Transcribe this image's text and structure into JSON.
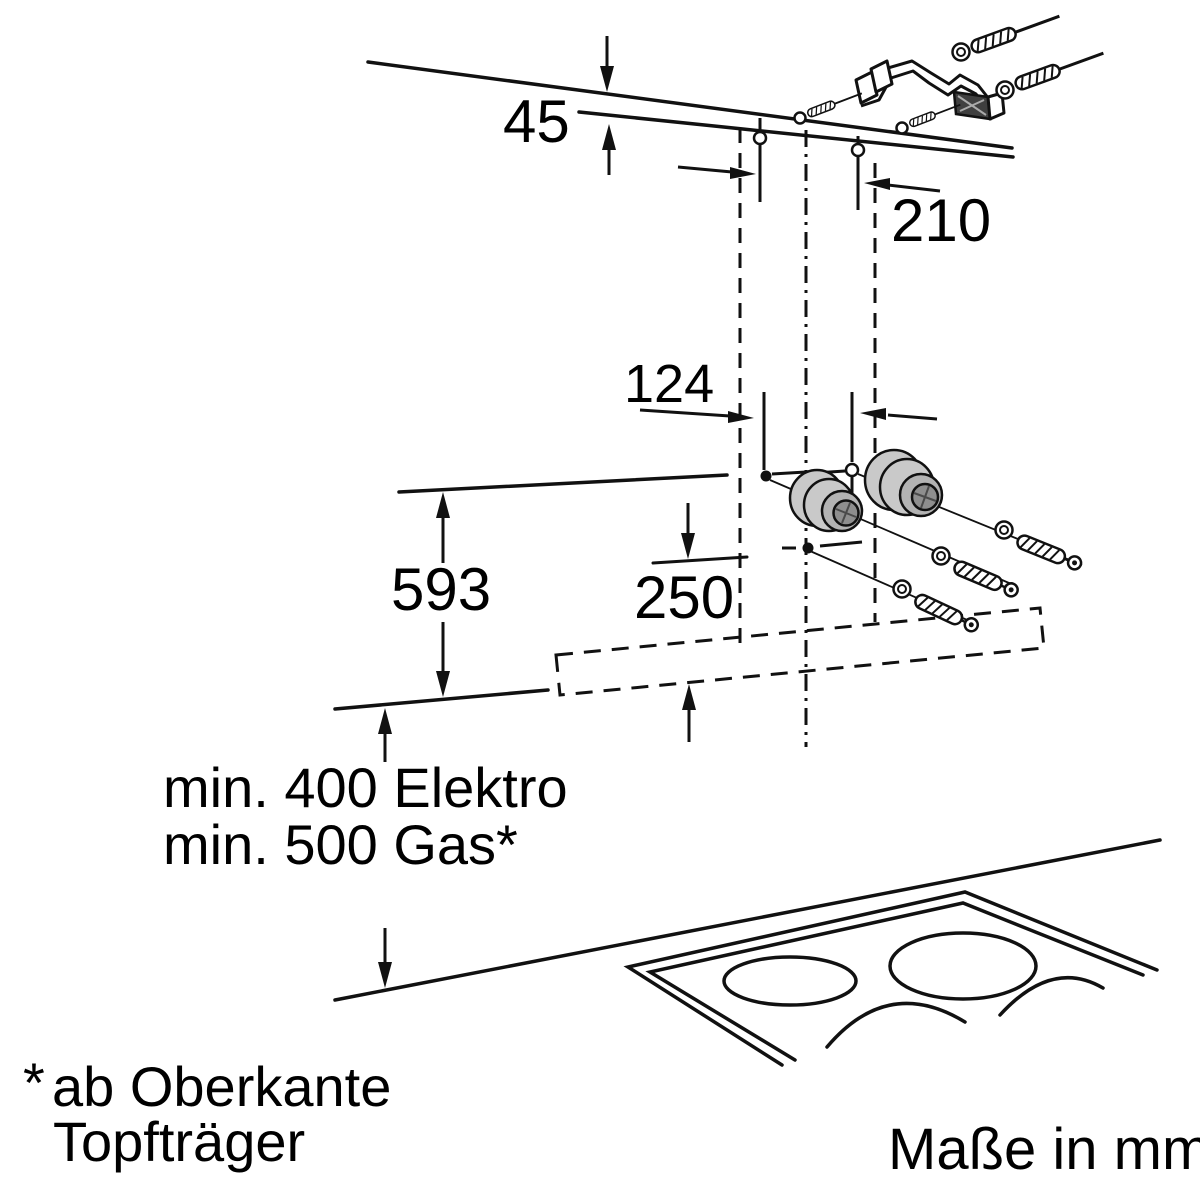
{
  "dimensions": {
    "ceiling_offset": "45",
    "upper_bracket_offset": "210",
    "hole_spacing": "124",
    "chimney_height": "593",
    "lower_mount_offset": "250"
  },
  "clearances": {
    "electric": "min. 400 Elektro",
    "gas": "min. 500 Gas*"
  },
  "footnote": {
    "marker": "*",
    "line1": "ab Oberkante",
    "line2": "Topfträger"
  },
  "units_note": "Maße in mm"
}
